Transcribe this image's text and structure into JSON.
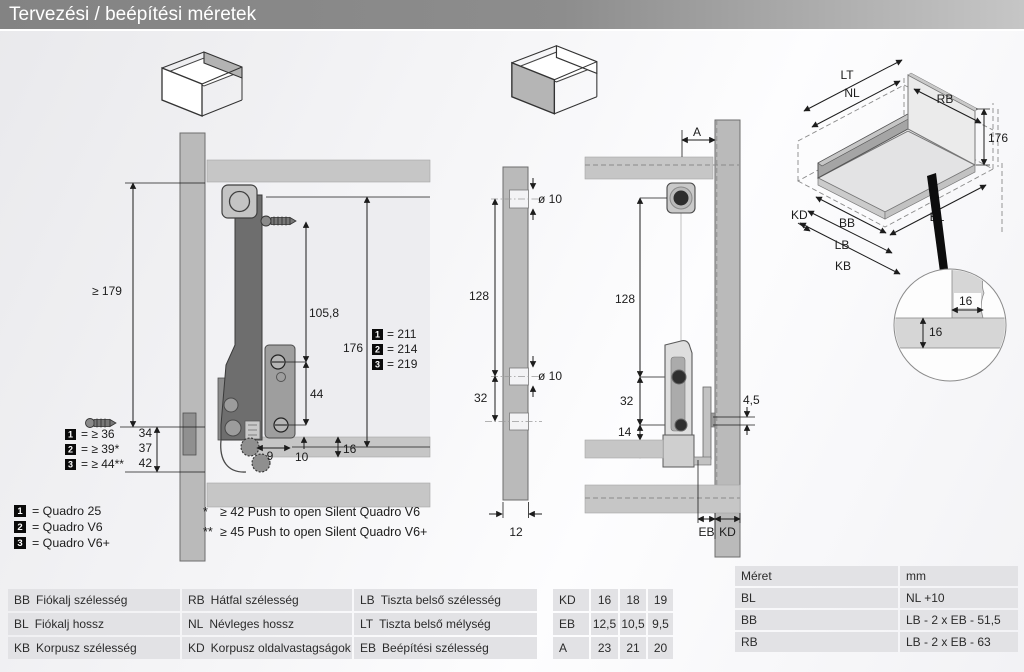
{
  "title": "Tervezési / beépítési méretek",
  "side_view": {
    "dims": {
      "min_height": "≥ 179",
      "screw_offset": "105,8",
      "back_height": "176",
      "hole_gap": "44",
      "d9": "9",
      "d10": "10",
      "d16": "16",
      "d34": "34",
      "d37": "37",
      "d42": "42"
    },
    "heights": [
      {
        "num": "1",
        "text": "= 211"
      },
      {
        "num": "2",
        "text": "= 214"
      },
      {
        "num": "3",
        "text": "= 219"
      }
    ],
    "clearances": [
      {
        "num": "1",
        "text": "= ≥ 36"
      },
      {
        "num": "2",
        "text": "= ≥ 39*"
      },
      {
        "num": "3",
        "text": "= ≥ 44**"
      }
    ]
  },
  "variants": [
    {
      "num": "1",
      "text": "= Quadro 25"
    },
    {
      "num": "2",
      "text": "= Quadro V6"
    },
    {
      "num": "3",
      "text": "= Quadro V6+"
    }
  ],
  "footnotes": [
    {
      "marker": "*",
      "text": "≥ 42 Push to open Silent Quadro V6"
    },
    {
      "marker": "**",
      "text": "≥ 45 Push to open Silent Quadro V6+"
    }
  ],
  "back_view": {
    "d10_top": "ø 10",
    "d10_mid": "ø 10",
    "v128": "128",
    "v32": "32",
    "w12": "12"
  },
  "front_view": {
    "a": "A",
    "v128": "128",
    "v32": "32",
    "v14": "14",
    "v16": "16",
    "t45": "4,5",
    "eb": "EB",
    "kd": "KD"
  },
  "iso": {
    "lt": "LT",
    "nl": "NL",
    "rb": "RB",
    "h176": "176",
    "kd": "KD",
    "bb": "BB",
    "lb": "LB",
    "kb": "KB",
    "bl": "BL",
    "detail_w": "16",
    "detail_t": "16"
  },
  "abbr_table": {
    "rows": [
      [
        {
          "code": "BB",
          "label": "Fiókalj szélesség"
        },
        {
          "code": "RB",
          "label": "Hátfal szélesség"
        },
        {
          "code": "LB",
          "label": "Tiszta belső szélesség"
        }
      ],
      [
        {
          "code": "BL",
          "label": "Fiókalj hossz"
        },
        {
          "code": "NL",
          "label": "Névleges hossz"
        },
        {
          "code": "LT",
          "label": "Tiszta belső mélység"
        }
      ],
      [
        {
          "code": "KB",
          "label": "Korpusz szélesség"
        },
        {
          "code": "KD",
          "label": "Korpusz oldalvastagságok"
        },
        {
          "code": "EB",
          "label": "Beépítési szélesség"
        }
      ]
    ]
  },
  "kd_table": {
    "rows": [
      {
        "label": "KD",
        "v1": "16",
        "v2": "18",
        "v3": "19"
      },
      {
        "label": "EB",
        "v1": "12,5",
        "v2": "10,5",
        "v3": "9,5"
      },
      {
        "label": "A",
        "v1": "23",
        "v2": "21",
        "v3": "20"
      }
    ]
  },
  "size_table": {
    "header": {
      "c1": "Méret",
      "c2": "mm"
    },
    "rows": [
      {
        "code": "BL",
        "formula": "NL +10"
      },
      {
        "code": "BB",
        "formula": "LB - 2 x EB - 51,5"
      },
      {
        "code": "RB",
        "formula": "LB - 2 x EB - 63"
      }
    ]
  }
}
